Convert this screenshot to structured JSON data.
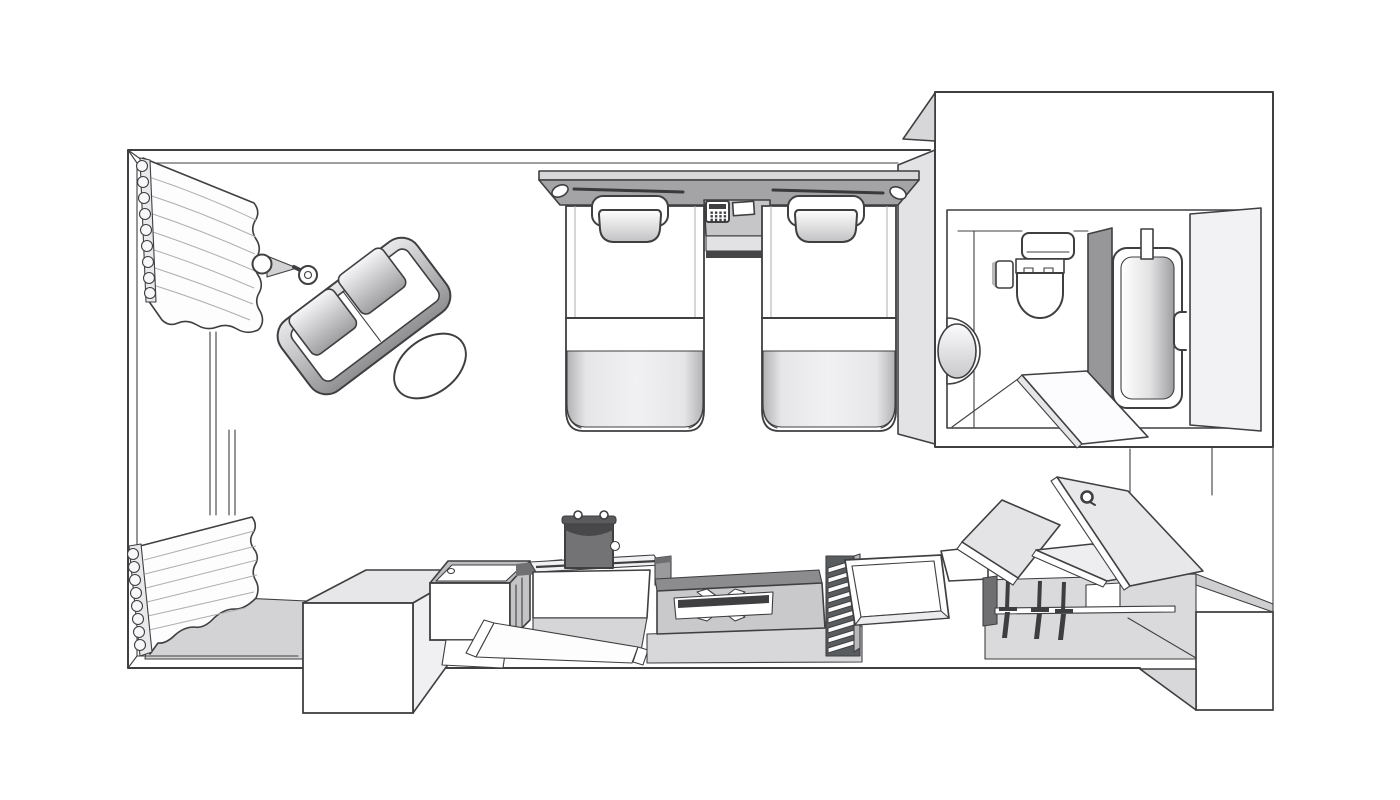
{
  "diagram": {
    "type": "floor-plan",
    "subject": "hotel twin guest room, top-down isometric line drawing, no text labels",
    "palette": {
      "background": "#ffffff",
      "outline": "#3f3f41",
      "light_gray": "#ececee",
      "mid_gray": "#c6c6c8",
      "dark_gray": "#9a9a9c",
      "shadow": "#707073"
    },
    "rooms": [
      {
        "id": "bedroom",
        "label": "Bedroom with twin beds"
      },
      {
        "id": "window-bay",
        "label": "Window bay with pleated curtains"
      },
      {
        "id": "bathroom",
        "label": "Bathroom with tub, toilet and basin"
      },
      {
        "id": "closet",
        "label": "Open closet with hanging rod"
      }
    ],
    "counts": {
      "beds": 2,
      "pillows": 2,
      "hangers": 3,
      "sofa_seats": 2,
      "curtains": 2,
      "reading_lights": 2
    },
    "items": [
      {
        "id": "upper-curtain",
        "label": "Pleated curtain - upper window"
      },
      {
        "id": "lower-curtain",
        "label": "Pleated curtain - lower window"
      },
      {
        "id": "window-frame",
        "label": "Window frame lines"
      },
      {
        "id": "floor-lamp",
        "label": "Floor lamp"
      },
      {
        "id": "sofa",
        "label": "Two-seat sofa"
      },
      {
        "id": "coffee-table",
        "label": "Oval coffee table"
      },
      {
        "id": "headboard",
        "label": "Headboard panel with two reading lights"
      },
      {
        "id": "nightstand",
        "label": "Bedside console between beds"
      },
      {
        "id": "telephone",
        "label": "Telephone with keypad"
      },
      {
        "id": "notepad",
        "label": "Memo pad"
      },
      {
        "id": "bed-left",
        "label": "Twin bed (left) with pillow and folded blanket"
      },
      {
        "id": "bed-right",
        "label": "Twin bed (right) with pillow and folded blanket"
      },
      {
        "id": "bathroom-walls",
        "label": "Bathroom walls"
      },
      {
        "id": "toilet",
        "label": "Toilet with tank and control panel"
      },
      {
        "id": "washbasin",
        "label": "Round washbasin"
      },
      {
        "id": "tub-partition",
        "label": "Bathtub partition wall"
      },
      {
        "id": "bathtub",
        "label": "Bathtub"
      },
      {
        "id": "entry-door",
        "label": "Door panel with handle"
      },
      {
        "id": "bathroom-door",
        "label": "Bathroom door swung open"
      },
      {
        "id": "luggage-bench",
        "label": "Luggage bench"
      },
      {
        "id": "fridge",
        "label": "Minibar cabinet with amenity tray"
      },
      {
        "id": "kettle",
        "label": "Electric kettle"
      },
      {
        "id": "counter",
        "label": "Tea counter"
      },
      {
        "id": "luggage-rack",
        "label": "Folding luggage-rack panel with X brace"
      },
      {
        "id": "slat-rack",
        "label": "Slatted rack"
      },
      {
        "id": "storage-box",
        "label": "Open storage box"
      },
      {
        "id": "closet-area",
        "label": "Closet interior"
      },
      {
        "id": "closet-door-left",
        "label": "Closet door panel (left)"
      },
      {
        "id": "closet-door-right",
        "label": "Closet door panel (right, with hook)"
      },
      {
        "id": "closet-shelf",
        "label": "Closet shelf panel"
      },
      {
        "id": "hanger-rod",
        "label": "Hanging rod"
      },
      {
        "id": "hangers",
        "label": "Three clothes hangers"
      },
      {
        "id": "room-walls",
        "label": "Room walls and floor"
      }
    ]
  }
}
